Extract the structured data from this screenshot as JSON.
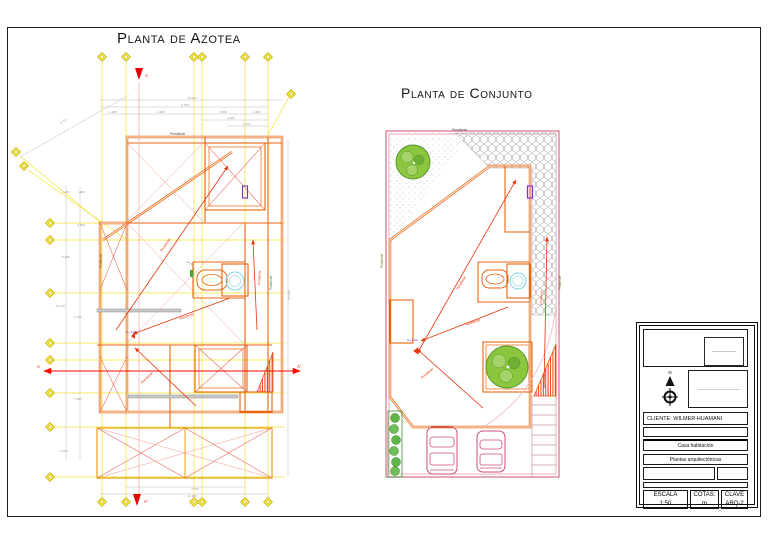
{
  "titles": {
    "azotea": "Planta de Azotea",
    "conjunto": "Planta de Conjunto"
  },
  "labels": {
    "pendiente": "Pendiente",
    "level_mark": "N.+2.60",
    "section_a": "A",
    "section_a_prime": "A'",
    "north": "N",
    "diag_dim": "6.721"
  },
  "azotea": {
    "dims_top": [
      "10.280",
      "8.730",
      "1.180",
      "4.280",
      "2.960",
      "1.060",
      "2.680",
      "2.337"
    ],
    "dims_left": [
      "1.480",
      "1.290",
      "2.800",
      "5.080",
      "10.475",
      "2.045",
      "1.835",
      "2.975"
    ],
    "dims_bottom": [
      "4.730",
      "10.280"
    ],
    "dim_right": "20.350"
  },
  "titleblock": {
    "cliente": "CLIENTE: WILMER HUAMANI",
    "project": "Casa habitación",
    "sheet_name": "Plantas arquitectónicas",
    "escala_label": "ESCALA",
    "escala_value": "1:50",
    "cotas_label": "COTAS:",
    "cotas_value": "m",
    "clave_label": "CLAVE",
    "clave_value": "ARQ-2"
  },
  "colors": {
    "wall_orange": "#E8650D",
    "grid_yellow": "#F0E32C",
    "section_red": "#FF0800",
    "pendiente_red": "#E8320C",
    "boundary_pink": "#D96C85",
    "tree_green": "#5FB548",
    "fixture_cyan": "#7FD4E4",
    "symbol_purple": "#7B2FBE",
    "dim_gray": "#999999"
  }
}
